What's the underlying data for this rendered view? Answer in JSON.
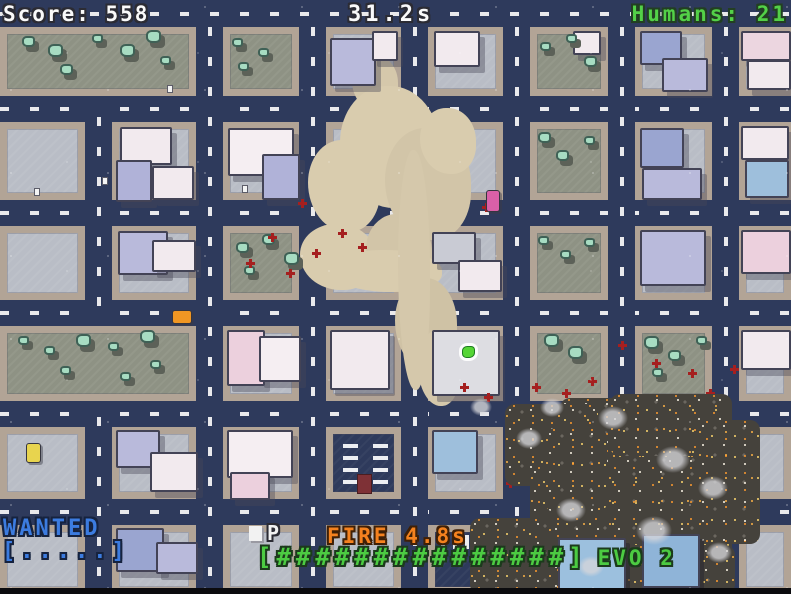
{
  "hud": {
    "score": "Score: 558",
    "timer": "31.2s",
    "humans": "Humans: 21",
    "wanted_label": "WANTED",
    "wanted_meter": "[.....]",
    "parking_symbol": "P",
    "fire_timer": "FIRE 4.8s",
    "evo_meter": "[###############]",
    "evo_label": "EVO 2"
  },
  "colors": {
    "road": "#2e3a5c",
    "road_dash": "#e9e9ec",
    "sidewalk": "#b2a496",
    "block_ground": "#b9bdc6",
    "park_ground": "#8e9284",
    "tree_light": "#a7dcc2",
    "tree_dark": "#3f6156",
    "crater_tan": "#d9ccae",
    "burnt": "#57544e",
    "spark_yellow": "#ffd76f",
    "spark_orange": "#ff9b2e",
    "blood_red": "#a51f1f",
    "hud_white": "#fafafa",
    "hud_green": "#53d148",
    "hud_blue": "#3c7ce0",
    "hud_orange": "#f5821f",
    "player_green": "#55d535"
  },
  "map": {
    "roads_h": [
      [
        0,
        0,
        791,
        27
      ],
      [
        0,
        96,
        791,
        26
      ],
      [
        0,
        200,
        791,
        26
      ],
      [
        0,
        300,
        791,
        26
      ],
      [
        0,
        401,
        791,
        26
      ],
      [
        0,
        499,
        791,
        26
      ]
    ],
    "roads_v": [
      [
        85,
        27,
        27,
        567
      ],
      [
        196,
        27,
        27,
        567
      ],
      [
        299,
        27,
        27,
        567
      ],
      [
        401,
        27,
        27,
        567
      ],
      [
        503,
        27,
        27,
        567
      ],
      [
        608,
        27,
        27,
        567
      ],
      [
        712,
        27,
        27,
        567
      ]
    ],
    "blocks": [
      [
        223,
        27,
        76,
        69,
        "park"
      ],
      [
        326,
        27,
        75,
        69,
        "plain"
      ],
      [
        428,
        27,
        75,
        69,
        "plain"
      ],
      [
        530,
        27,
        78,
        69,
        "park"
      ],
      [
        635,
        27,
        77,
        69,
        "plain"
      ],
      [
        739,
        27,
        52,
        69,
        "plain"
      ],
      [
        0,
        122,
        85,
        78,
        "plain"
      ],
      [
        112,
        122,
        84,
        78,
        "plain"
      ],
      [
        223,
        122,
        76,
        78,
        "plain"
      ],
      [
        326,
        122,
        75,
        78,
        "plain"
      ],
      [
        428,
        122,
        75,
        78,
        "plain"
      ],
      [
        530,
        122,
        78,
        78,
        "park"
      ],
      [
        635,
        122,
        77,
        78,
        "plain"
      ],
      [
        739,
        122,
        52,
        78,
        "plain"
      ],
      [
        0,
        226,
        85,
        74,
        "plain"
      ],
      [
        112,
        226,
        84,
        74,
        "plain"
      ],
      [
        223,
        226,
        76,
        74,
        "park"
      ],
      [
        326,
        226,
        75,
        74,
        "plain"
      ],
      [
        428,
        226,
        75,
        74,
        "plain"
      ],
      [
        530,
        226,
        78,
        74,
        "park"
      ],
      [
        635,
        226,
        77,
        74,
        "plain"
      ],
      [
        739,
        226,
        52,
        74,
        "plain"
      ],
      [
        223,
        326,
        76,
        75,
        "plain"
      ],
      [
        326,
        326,
        75,
        75,
        "plain"
      ],
      [
        428,
        326,
        75,
        75,
        "plain"
      ],
      [
        530,
        326,
        78,
        75,
        "park"
      ],
      [
        635,
        326,
        77,
        75,
        "park"
      ],
      [
        739,
        326,
        52,
        75,
        "plain"
      ],
      [
        0,
        427,
        85,
        72,
        "plain"
      ],
      [
        112,
        427,
        84,
        72,
        "plain"
      ],
      [
        223,
        427,
        76,
        72,
        "plain"
      ],
      [
        326,
        427,
        75,
        72,
        "pstruct"
      ],
      [
        428,
        427,
        75,
        72,
        "plain"
      ],
      [
        530,
        427,
        78,
        72,
        "burnt"
      ],
      [
        635,
        427,
        77,
        72,
        "burnt"
      ],
      [
        739,
        427,
        52,
        72,
        "plain"
      ],
      [
        0,
        525,
        85,
        69,
        "plain"
      ],
      [
        112,
        525,
        84,
        69,
        "plain"
      ],
      [
        223,
        525,
        76,
        69,
        "plain"
      ],
      [
        326,
        525,
        75,
        69,
        "plain"
      ],
      [
        428,
        525,
        75,
        69,
        "plot"
      ],
      [
        530,
        525,
        78,
        69,
        "burnt"
      ],
      [
        635,
        525,
        77,
        69,
        "burnt"
      ],
      [
        739,
        525,
        52,
        69,
        "plain"
      ]
    ],
    "blocks_over": [
      [
        0,
        27,
        196,
        69,
        "park"
      ],
      [
        0,
        326,
        196,
        75,
        "park"
      ]
    ],
    "crater": [
      [
        352,
        55,
        46,
        56,
        "#d5c8ab"
      ],
      [
        340,
        86,
        100,
        122,
        "#d9ccae"
      ],
      [
        308,
        140,
        72,
        92,
        "#d9ccae"
      ],
      [
        385,
        128,
        86,
        112,
        "#d2c5a8"
      ],
      [
        300,
        224,
        76,
        66,
        "#d9ccae"
      ],
      [
        366,
        214,
        66,
        76,
        "#d2c5a8"
      ],
      [
        420,
        108,
        56,
        66,
        "#d9ccae"
      ],
      [
        330,
        250,
        112,
        42,
        "#d9ccae"
      ],
      [
        395,
        278,
        62,
        92,
        "#cfc2a5"
      ],
      [
        398,
        150,
        32,
        240,
        "#d5c8ab"
      ],
      [
        418,
        330,
        42,
        76,
        "#d5c8ab"
      ]
    ],
    "buildings": [
      [
        330,
        38,
        42,
        44,
        "#b9badb"
      ],
      [
        372,
        31,
        22,
        26,
        "#f2eaee"
      ],
      [
        434,
        31,
        42,
        32,
        "#f2eaee"
      ],
      [
        573,
        31,
        24,
        20,
        "#f2eaee"
      ],
      [
        640,
        31,
        38,
        30,
        "#9aa5d0"
      ],
      [
        662,
        58,
        42,
        30,
        "#b9badb"
      ],
      [
        741,
        31,
        46,
        26,
        "#ecd6e0"
      ],
      [
        747,
        60,
        40,
        26,
        "#f2eaee"
      ],
      [
        120,
        127,
        48,
        34,
        "#f2eaee"
      ],
      [
        116,
        160,
        32,
        38,
        "#b0b2d8"
      ],
      [
        152,
        166,
        38,
        30,
        "#f2eaee"
      ],
      [
        228,
        128,
        62,
        44,
        "#f5eef2"
      ],
      [
        262,
        154,
        34,
        42,
        "#b0b2d8"
      ],
      [
        640,
        128,
        40,
        36,
        "#9aa5d0"
      ],
      [
        642,
        168,
        56,
        28,
        "#b9badb"
      ],
      [
        741,
        126,
        44,
        30,
        "#f2eaee"
      ],
      [
        745,
        160,
        40,
        34,
        "#9ebfdc"
      ],
      [
        118,
        231,
        46,
        40,
        "#b9badb"
      ],
      [
        152,
        240,
        40,
        28,
        "#f2eaee"
      ],
      [
        432,
        232,
        40,
        28,
        "#c9cbd4"
      ],
      [
        458,
        260,
        40,
        28,
        "#f2eaee"
      ],
      [
        640,
        230,
        62,
        52,
        "#b9badb"
      ],
      [
        741,
        230,
        46,
        40,
        "#ecd0dd"
      ],
      [
        227,
        330,
        34,
        52,
        "#ecd0dd"
      ],
      [
        259,
        336,
        38,
        42,
        "#f5eef2"
      ],
      [
        330,
        330,
        56,
        56,
        "#f2eaee"
      ],
      [
        432,
        330,
        64,
        62,
        "#dddde2"
      ],
      [
        741,
        330,
        46,
        36,
        "#f2eaee"
      ],
      [
        116,
        430,
        40,
        34,
        "#b9badb"
      ],
      [
        150,
        452,
        44,
        36,
        "#f2eaee"
      ],
      [
        227,
        430,
        62,
        44,
        "#f5eef2"
      ],
      [
        230,
        472,
        36,
        24,
        "#ecd0dd"
      ],
      [
        432,
        430,
        42,
        40,
        "#9ebfdc"
      ],
      [
        116,
        528,
        44,
        40,
        "#9aa5d0"
      ],
      [
        156,
        542,
        38,
        28,
        "#b9badb"
      ]
    ],
    "over_fire": [
      [
        558,
        538,
        64,
        50,
        "#9cc0de"
      ],
      [
        642,
        534,
        54,
        50,
        "#8fb4d8"
      ]
    ],
    "trees": [
      [
        22,
        36
      ],
      [
        48,
        44
      ],
      [
        92,
        34
      ],
      [
        120,
        44
      ],
      [
        146,
        30
      ],
      [
        60,
        64
      ],
      [
        160,
        56
      ],
      [
        232,
        38
      ],
      [
        258,
        48
      ],
      [
        238,
        62
      ],
      [
        540,
        42
      ],
      [
        566,
        34
      ],
      [
        584,
        56
      ],
      [
        538,
        132
      ],
      [
        556,
        150
      ],
      [
        584,
        136
      ],
      [
        236,
        242
      ],
      [
        262,
        234
      ],
      [
        284,
        252
      ],
      [
        244,
        266
      ],
      [
        538,
        236
      ],
      [
        560,
        250
      ],
      [
        584,
        238
      ],
      [
        18,
        336
      ],
      [
        44,
        346
      ],
      [
        76,
        334
      ],
      [
        108,
        342
      ],
      [
        140,
        330
      ],
      [
        60,
        366
      ],
      [
        150,
        360
      ],
      [
        120,
        372
      ],
      [
        544,
        334
      ],
      [
        568,
        346
      ],
      [
        644,
        336
      ],
      [
        668,
        350
      ],
      [
        696,
        336
      ],
      [
        652,
        368
      ]
    ],
    "blood": [
      [
        298,
        202
      ],
      [
        268,
        236
      ],
      [
        246,
        262
      ],
      [
        312,
        252
      ],
      [
        338,
        232
      ],
      [
        286,
        272
      ],
      [
        358,
        246
      ],
      [
        482,
        206
      ],
      [
        460,
        386
      ],
      [
        484,
        396
      ],
      [
        532,
        386
      ],
      [
        562,
        392
      ],
      [
        588,
        380
      ],
      [
        618,
        344
      ],
      [
        652,
        362
      ],
      [
        688,
        372
      ],
      [
        706,
        392
      ],
      [
        728,
        424
      ],
      [
        748,
        432
      ],
      [
        556,
        478
      ],
      [
        506,
        482
      ],
      [
        730,
        368
      ]
    ],
    "cars": [
      [
        172,
        310,
        18,
        12,
        "#f09623"
      ],
      [
        26,
        443,
        13,
        18,
        "#e8d44e"
      ],
      [
        486,
        190,
        12,
        20,
        "#d960a8"
      ]
    ],
    "humans": [
      [
        35,
        189
      ],
      [
        103,
        178
      ],
      [
        243,
        186
      ],
      [
        168,
        86
      ]
    ],
    "player": [
      462,
      346
    ],
    "fire": [
      [
        560,
        398,
        172,
        102
      ],
      [
        505,
        404,
        92,
        82
      ],
      [
        530,
        466,
        202,
        128
      ],
      [
        470,
        518,
        82,
        76
      ],
      [
        610,
        394,
        122,
        62
      ],
      [
        698,
        420,
        62,
        124
      ],
      [
        545,
        428,
        62,
        84
      ],
      [
        575,
        545,
        160,
        49
      ]
    ],
    "smoke": [
      [
        516,
        428,
        26
      ],
      [
        598,
        406,
        30
      ],
      [
        656,
        446,
        34
      ],
      [
        556,
        498,
        30
      ],
      [
        636,
        516,
        36
      ],
      [
        698,
        476,
        30
      ],
      [
        706,
        542,
        26
      ],
      [
        578,
        556,
        26
      ],
      [
        470,
        398,
        22
      ],
      [
        540,
        398,
        24
      ]
    ]
  }
}
